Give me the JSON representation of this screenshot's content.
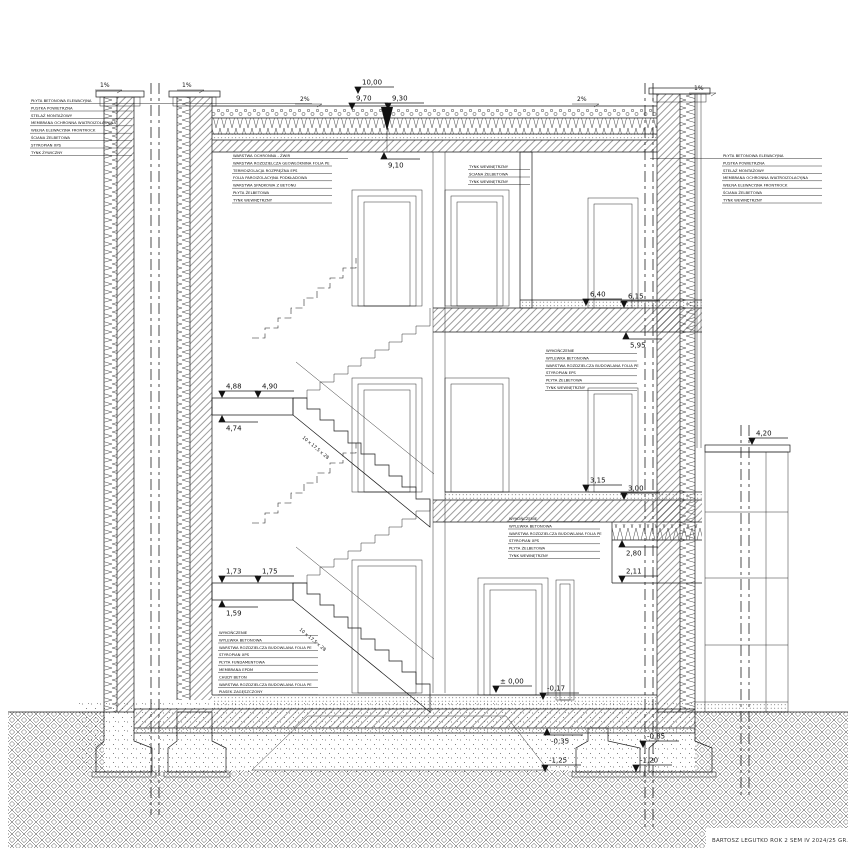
{
  "meta": {
    "title_block": "BARTOSZ LEGUTKO ROK 2 SEM IV 2024/25 GR. WG"
  },
  "levels": [
    "10,00",
    "9,70",
    "9,30",
    "9,10",
    "6,40",
    "6,15",
    "5,95",
    "4,88",
    "4,90",
    "4,74",
    "4,20",
    "3,15",
    "3,00",
    "2,80",
    "2,11",
    "1,73",
    "1,75",
    "1,59",
    "± 0,00",
    "-0,17",
    "-0,35",
    "-0,85",
    "-1,25",
    "-1,20"
  ],
  "slopes": [
    "1%",
    "1%",
    "2%",
    "2%",
    "1%"
  ],
  "stair": {
    "flight_label": "10 x 17,5 x 28"
  },
  "notes": {
    "left": [
      "PŁYTA BETONOWA ELEWACYJNA",
      "PUSTKA POWIETRZNA",
      "STELAŻ MONTAŻOWY",
      "MEMBRANA OCHRONNA WIATROIZOLACYJNA",
      "WEŁNA ELEWACYJNA FRONTROCK",
      "ŚCIANA ŻELBETOWA",
      "STYROPIAN XPS",
      "TYNK ŻYWICZNY"
    ],
    "roof": [
      "WARSTWA OCHRONNA - ŻWIR",
      "WARSTWA ROZDZIELCZA GEOWŁÓKNINA FOLIA PE",
      "TERMOIZOLACJA ROZPRĘŻNA EPS",
      "FOLIA PAROIZOLACYJNA PODKŁADOWA",
      "WARSTWA SPADKOWA Z BETONU",
      "PŁYTA ŻELBETOWA",
      "TYNK WEWNĘTRZNY"
    ],
    "interior_wall": [
      "TYNK WEWNĘTRZNY",
      "ŚCIANA ŻELBETOWA",
      "TYNK WEWNĘTRZNY"
    ],
    "floor_upper": [
      "WYKOŃCZENIE",
      "WYLEWKA BETONOWA",
      "WARSTWA ROZDZIELCZA BUDOWLANA FOLIA PE",
      "STYROPIAN EPS",
      "PŁYTA ŻELBETOWA",
      "TYNK WEWNĘTRZNY"
    ],
    "floor_lower": [
      "WYKOŃCZENIE",
      "WYLEWKA BETONOWA",
      "WARSTWA ROZDZIELCZA BUDOWLANA FOLIA PE",
      "STYROPIAN XPS",
      "PŁYTA ŻELBETOWA",
      "TYNK WEWNĘTRZNY"
    ],
    "ground_floor": [
      "WYKOŃCZENIE",
      "WYLEWKA BETONOWA",
      "WARSTWA ROZDZIELCZA BUDOWLANA FOLIA PE",
      "STYROPIAN XPS",
      "PŁYTA FUNDAMENTOWA",
      "MEMBRANA EPDM",
      "CHUDY BETON",
      "WARSTWA ROZDZIELCZA BUDOWLANA FOLIA PE",
      "PIASEK ZAGĘSZCZONY"
    ],
    "right": [
      "PŁYTA BETONOWA ELEWACYJNA",
      "PUSTKA POWIETRZNA",
      "STELAŻ MONTAŻOWY",
      "MEMBRANA OCHRONNA WIATROIZOLACYJNA",
      "WEŁNA ELEWACYJNA FRONTROCK",
      "ŚCIANA ŻELBETOWA",
      "TYNK WEWNĘTRZNY"
    ]
  }
}
